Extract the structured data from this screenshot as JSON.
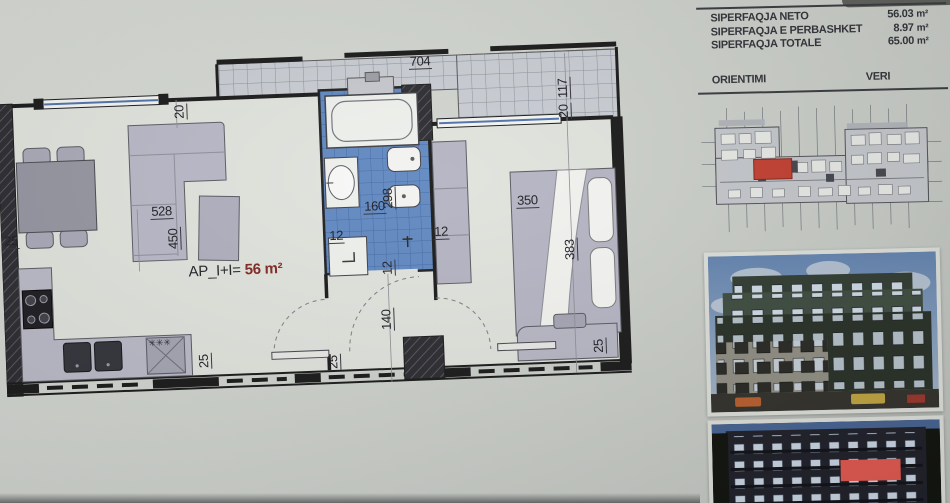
{
  "panel": {
    "area_table": {
      "rows": [
        {
          "label": "SIPERFAQJA NETO",
          "value": "56.03",
          "unit": "m²"
        },
        {
          "label": "SIPERFAQJA E PERBASHKET",
          "value": "8.97",
          "unit": "m²"
        },
        {
          "label": "SIPERFAQJA TOTALE",
          "value": "65.00",
          "unit": "m²"
        }
      ]
    },
    "orientation": {
      "label": "ORIENTIMI",
      "value": "VERI"
    }
  },
  "floor_plan": {
    "apartment_label": "AP_I+I=",
    "apartment_area": "56 m²",
    "dimensions": [
      {
        "text": "704",
        "x": 414,
        "y": 6,
        "rot": 0
      },
      {
        "text": "20",
        "x": 176,
        "y": 62,
        "rot": -90
      },
      {
        "text": "117",
        "x": 560,
        "y": 56,
        "rot": -90
      },
      {
        "text": "20",
        "x": 560,
        "y": 76,
        "rot": -90
      },
      {
        "text": "528",
        "x": 150,
        "y": 146,
        "rot": 0
      },
      {
        "text": "450",
        "x": 165,
        "y": 192,
        "rot": -90
      },
      {
        "text": "25",
        "x": 2,
        "y": 170,
        "rot": 0
      },
      {
        "text": "298",
        "x": 381,
        "y": 160,
        "rot": -90
      },
      {
        "text": "160",
        "x": 363,
        "y": 149,
        "rot": 0
      },
      {
        "text": "12",
        "x": 327,
        "y": 177,
        "rot": 0
      },
      {
        "text": "12",
        "x": 432,
        "y": 177,
        "rot": 0
      },
      {
        "text": "12",
        "x": 378,
        "y": 226,
        "rot": -90
      },
      {
        "text": "140",
        "x": 375,
        "y": 281,
        "rot": -90
      },
      {
        "text": "25",
        "x": 320,
        "y": 318,
        "rot": -90
      },
      {
        "text": "25",
        "x": 191,
        "y": 312,
        "rot": -90
      },
      {
        "text": "350",
        "x": 516,
        "y": 149,
        "rot": 0
      },
      {
        "text": "383",
        "x": 561,
        "y": 218,
        "rot": -90
      },
      {
        "text": "25",
        "x": 586,
        "y": 312,
        "rot": -90
      },
      {
        "text": "✳✳✳",
        "x": 142,
        "y": 277,
        "rot": 0,
        "small": true
      }
    ]
  },
  "colors": {
    "paper": "#ced1cb",
    "wall_ink": "#141414",
    "bathroom_tile": "#5c85bf",
    "furniture_gray": "#b6b6c5",
    "highlight_red": "#c03a2b",
    "area_text_red": "#7d211c",
    "panel_ink": "#2c2d33"
  }
}
